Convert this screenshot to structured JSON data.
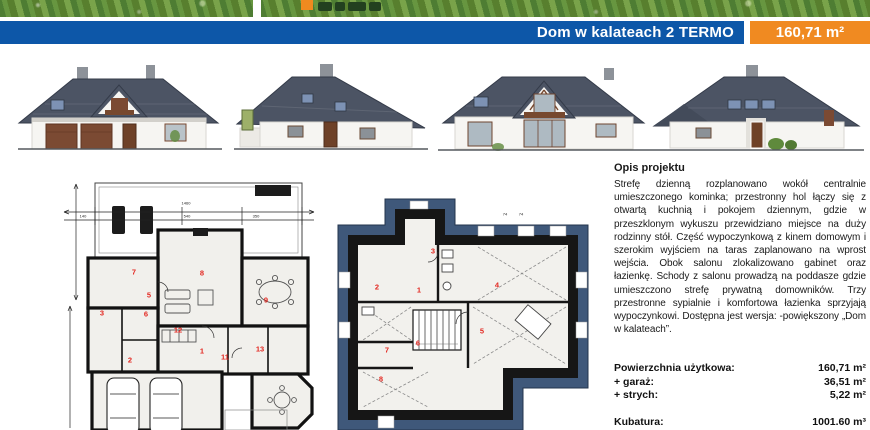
{
  "banner": {
    "title": "Dom w kalateach 2 TERMO",
    "area": "160,71 m²",
    "blue": "#0d57a8",
    "orange": "#f08a21"
  },
  "description": {
    "heading": "Opis projektu",
    "body": "Strefę dzienną rozplanowano wokół centralnie umieszczonego kominka; przestronny hol łączy się z otwartą kuchnią i pokojem dziennym, gdzie w przeszklonym wykuszu przewidziano miejsce na duży rodzinny stół. Część wypoczynkową z kinem domowym i szerokim wyjściem na taras zaplanowano na wprost wejścia. Obok salonu zlokalizowano gabinet oraz łazienkę. Schody z salonu prowadzą na poddasze gdzie umieszczono strefę prywatną domowników. Trzy przestronne sypialnie i komfortowa łazienka sprzyjają wypoczynkowi. Dostępna jest wersja: -powiększony „Dom w kalateach”."
  },
  "specs": {
    "rows": [
      {
        "label": "Powierzchnia użytkowa:",
        "value": "160,71 m²"
      },
      {
        "label": "+ garaż:",
        "value": "36,51 m²"
      },
      {
        "label": "+ strych:",
        "value": "5,22 m²"
      }
    ],
    "kubatura_label": "Kubatura:",
    "kubatura_value": "1001.60 m³"
  },
  "plans": {
    "ground_floor": {
      "labels": [
        {
          "t": "7",
          "x": 72,
          "y": 100,
          "k": "room"
        },
        {
          "t": "8",
          "x": 140,
          "y": 101,
          "k": "room"
        },
        {
          "t": "9",
          "x": 204,
          "y": 128,
          "k": "room"
        },
        {
          "t": "5",
          "x": 87,
          "y": 123,
          "k": "room"
        },
        {
          "t": "3",
          "x": 40,
          "y": 141,
          "k": "room"
        },
        {
          "t": "6",
          "x": 84,
          "y": 142,
          "k": "room"
        },
        {
          "t": "12",
          "x": 116,
          "y": 158,
          "k": "room"
        },
        {
          "t": "1",
          "x": 140,
          "y": 179,
          "k": "room"
        },
        {
          "t": "11",
          "x": 163,
          "y": 185,
          "k": "room"
        },
        {
          "t": "13",
          "x": 198,
          "y": 177,
          "k": "room"
        },
        {
          "t": "2",
          "x": 68,
          "y": 188,
          "k": "room"
        },
        {
          "t": "1460",
          "x": 124,
          "y": 31,
          "k": "dim"
        },
        {
          "t": "540",
          "x": 125,
          "y": 44,
          "k": "dim"
        },
        {
          "t": "350",
          "x": 194,
          "y": 44,
          "k": "dim"
        },
        {
          "t": "140",
          "x": 21,
          "y": 44,
          "k": "dim"
        }
      ]
    },
    "attic": {
      "labels": [
        {
          "t": "3",
          "x": 115,
          "y": 59,
          "k": "room"
        },
        {
          "t": "2",
          "x": 59,
          "y": 95,
          "k": "room"
        },
        {
          "t": "1",
          "x": 101,
          "y": 98,
          "k": "room"
        },
        {
          "t": "4",
          "x": 179,
          "y": 93,
          "k": "room"
        },
        {
          "t": "5",
          "x": 164,
          "y": 139,
          "k": "room"
        },
        {
          "t": "6",
          "x": 100,
          "y": 151,
          "k": "room"
        },
        {
          "t": "7",
          "x": 69,
          "y": 158,
          "k": "room"
        },
        {
          "t": "8",
          "x": 63,
          "y": 187,
          "k": "room"
        },
        {
          "t": "74",
          "x": 187,
          "y": 22,
          "k": "dim"
        },
        {
          "t": "74",
          "x": 203,
          "y": 22,
          "k": "dim"
        }
      ]
    }
  }
}
